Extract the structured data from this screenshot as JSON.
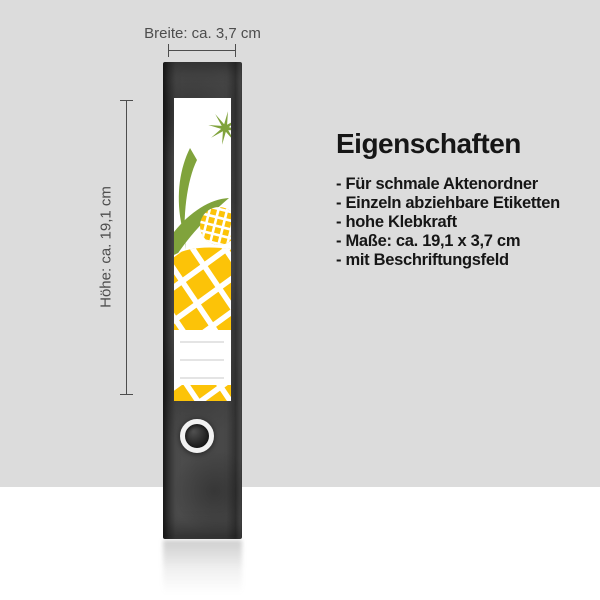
{
  "annotations": {
    "width_text": "Breite: ca. 3,7 cm",
    "height_text": "Höhe: ca. 19,1 cm"
  },
  "features": {
    "title": "Eigenschaften",
    "items": [
      "- Für schmale Aktenordner",
      "- Einzeln abziehbare Etiketten",
      "- hohe Klebkraft",
      "- Maße: ca. 19,1 x 3,7 cm",
      "- mit Beschriftungsfeld"
    ]
  },
  "colors": {
    "background": "#dcdcdc",
    "floor": "#ffffff",
    "spine": "#464646",
    "pineapple_yellow": "#fcc308",
    "leaf_green": "#80a33c",
    "annotation_gray": "#4d4d4d",
    "text_black": "#161616"
  }
}
